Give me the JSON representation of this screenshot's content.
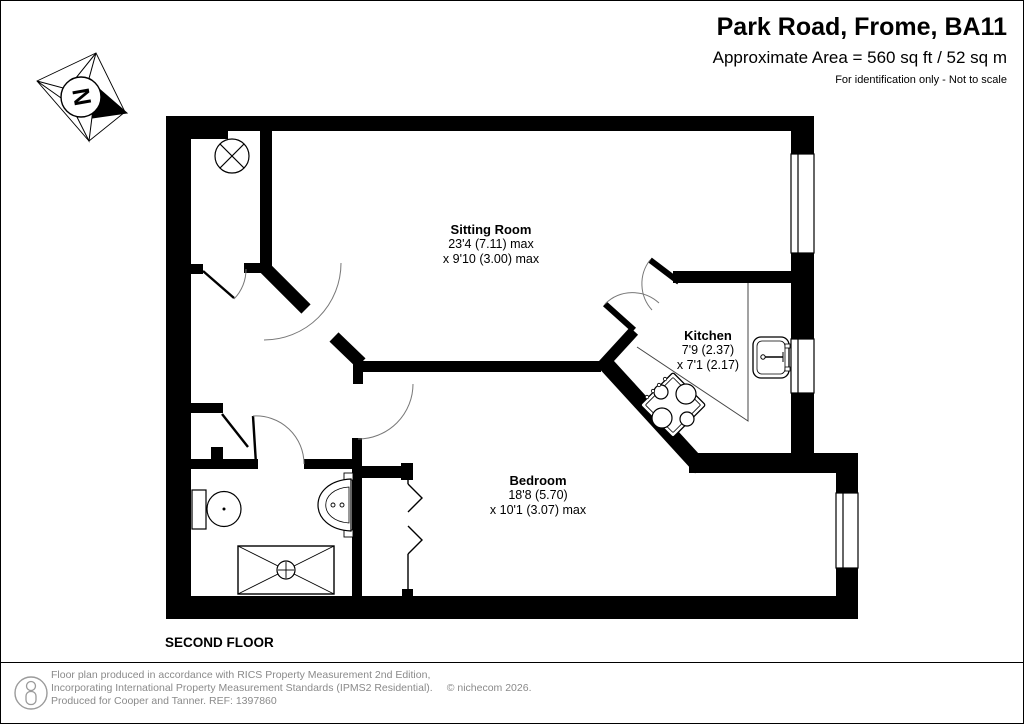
{
  "header": {
    "title": "Park Road, Frome, BA11",
    "area_line": "Approximate Area = 560 sq ft / 52 sq m",
    "disclaimer": "For identification only - Not to scale"
  },
  "plan": {
    "floor_label": "SECOND FLOOR",
    "compass_letter": "N",
    "rooms": [
      {
        "name": "Sitting Room",
        "dim1": "23'4 (7.11) max",
        "dim2": "x 9'10 (3.00) max"
      },
      {
        "name": "Kitchen",
        "dim1": "7'9 (2.37)",
        "dim2": "x 7'1 (2.17)"
      },
      {
        "name": "Bedroom",
        "dim1": "18'8 (5.70)",
        "dim2": "x 10'1 (3.07) max"
      }
    ]
  },
  "footer": {
    "line1": "Floor plan produced in accordance with RICS Property Measurement 2nd Edition,",
    "line2": "Incorporating International Property Measurement Standards (IPMS2 Residential).",
    "copyright": "© nichecom 2026.",
    "line3": "Produced for Cooper and Tanner.   REF: 1397860"
  },
  "colors": {
    "wall": "#000000",
    "door_arc": "#777777",
    "footer_text": "#8a8a8a"
  }
}
